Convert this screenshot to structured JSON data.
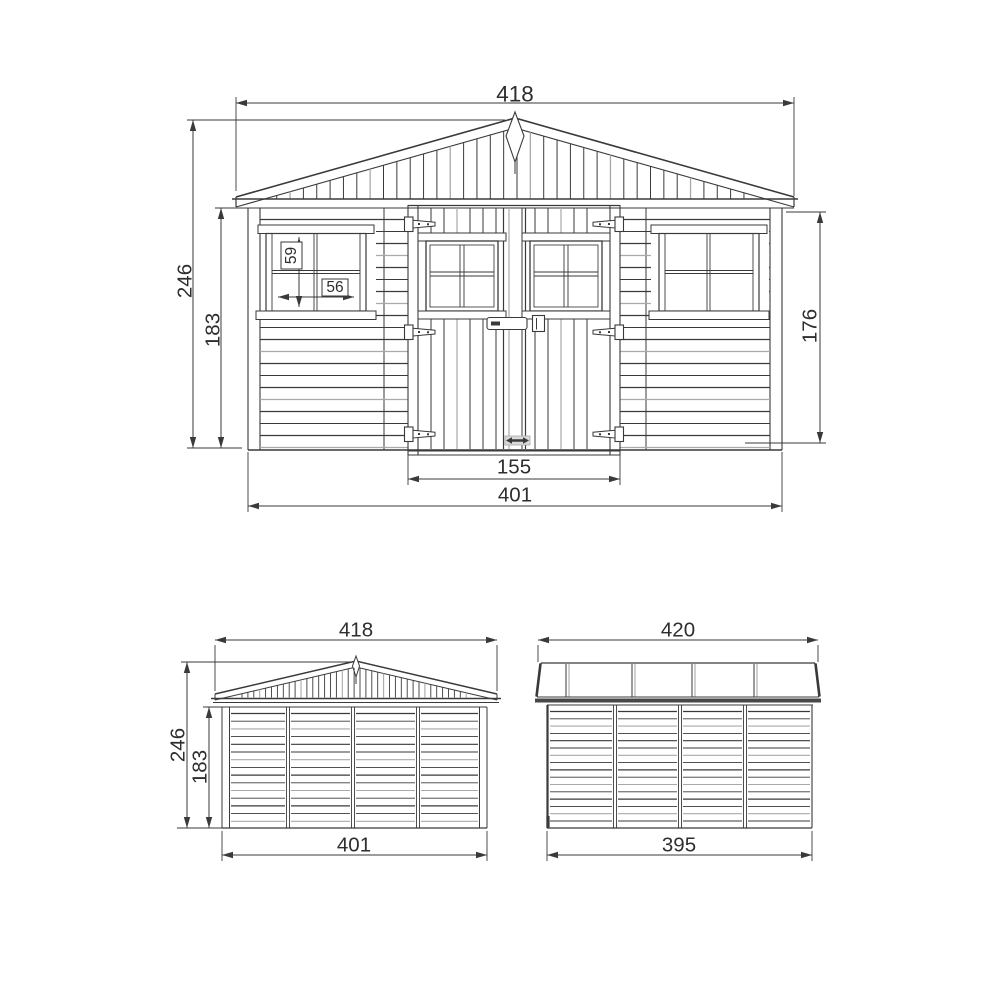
{
  "drawing": {
    "views": {
      "front": {
        "dims": {
          "overall_width": "418",
          "overall_height": "246",
          "wall_height_left": "183",
          "wall_height_right": "176",
          "window_height": "59",
          "window_width": "56",
          "door_width": "155",
          "base_width": "401"
        }
      },
      "rear": {
        "dims": {
          "overall_width": "418",
          "overall_height": "246",
          "wall_height": "183",
          "base_width": "401"
        }
      },
      "side": {
        "dims": {
          "roof_length": "420",
          "base_length": "395"
        }
      }
    },
    "colors": {
      "ink": "#3a3a3a",
      "light": "#a9a9a9",
      "accent_dark": "#474747",
      "background": "#ffffff"
    }
  }
}
